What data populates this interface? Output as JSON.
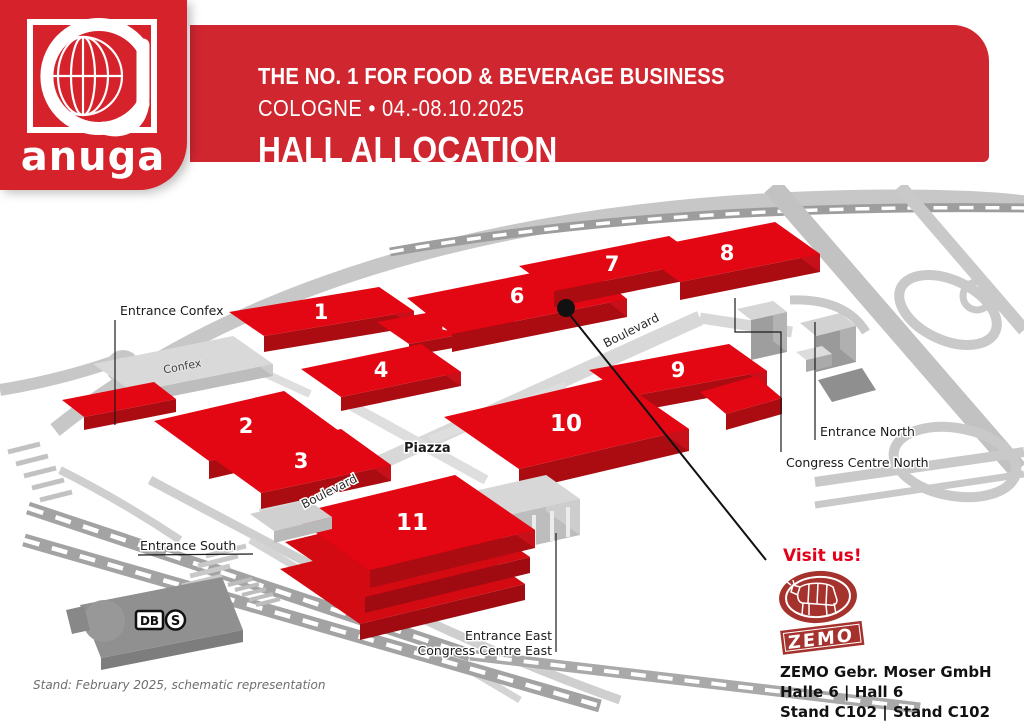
{
  "header": {
    "logo_wordmark": "anuga",
    "line1": "THE NO. 1 FOR FOOD & BEVERAGE BUSINESS",
    "line2": "COLOGNE • 04.-08.10.2025",
    "line3": "HALL ALLOCATION"
  },
  "colors": {
    "banner_red": "#cf2630",
    "logo_red": "#d5222b",
    "hall_top_red": "#e30613",
    "hall_side_red": "#ab0c12",
    "visit_red": "#e2001a",
    "zemo_brand_red": "#a5322c",
    "road_gray": "#c7c7c7",
    "building_gray": "#d6d6d6"
  },
  "map": {
    "halls": [
      "1",
      "2",
      "3",
      "4",
      "5",
      "6",
      "7",
      "8",
      "9",
      "10",
      "11"
    ],
    "labels": {
      "entrance_confex": "Entrance Confex",
      "confex": "Confex",
      "entrance_north": "Entrance North",
      "congress_centre_north": "Congress Centre North",
      "entrance_south": "Entrance South",
      "entrance_east": "Entrance East",
      "congress_centre_east": "Congress Centre East",
      "piazza": "Piazza",
      "boulevard": "Boulevard",
      "db": "DB",
      "sbahn": "S"
    }
  },
  "exhibitor": {
    "visit_us": "Visit us!",
    "logo_text": "ZEMO",
    "company": "ZEMO Gebr. Moser GmbH",
    "hall_line": "Halle 6 | Hall 6",
    "stand_line": "Stand C102 | Stand C102"
  },
  "footnote": "Stand: February 2025, schematic representation"
}
